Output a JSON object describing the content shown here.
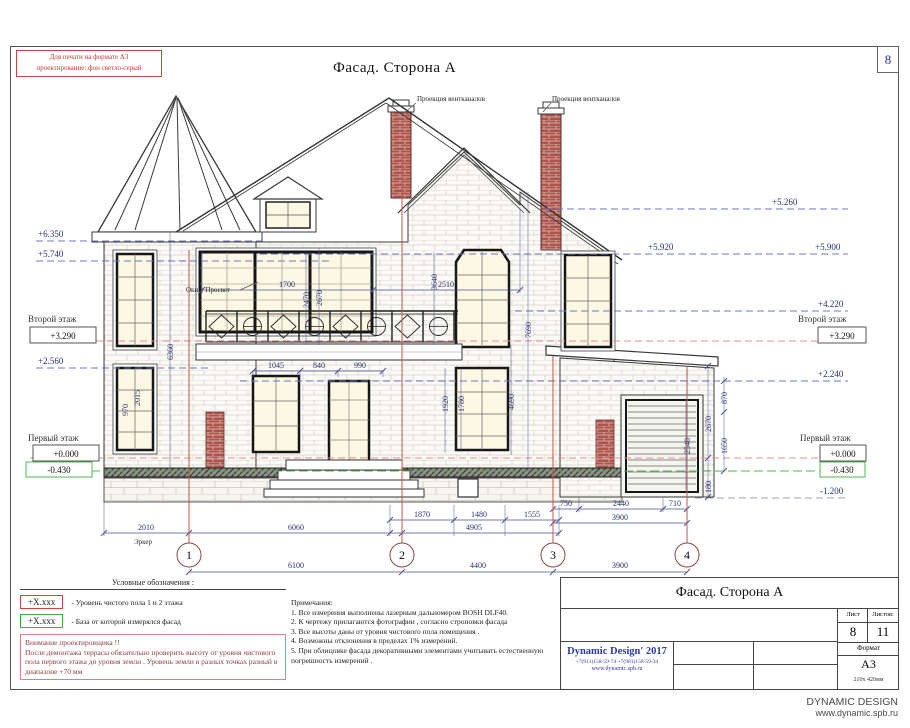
{
  "sheet": {
    "print_note_1": "Для печати на формате А3",
    "print_note_2": "проектирование: фон светло-серый",
    "page_number": "8",
    "title": "Фасад. Сторона А"
  },
  "annotations": {
    "vent_label_1": "Проекция вентканалов",
    "vent_label_2": "Проекция вентканалов",
    "window_label": "Окно: Просвет",
    "bay_label": "Эркер"
  },
  "levels": {
    "l_6350": "+6.350",
    "l_5740": "+5.740",
    "l_2560": "+2.560",
    "l_5260": "+5.260",
    "l_5920": "+5.920",
    "l_5900": "+5.900",
    "l_4220": "+4.220",
    "l_2240": "+2.240",
    "l_1200": "-1.200",
    "floor2_left": "Второй этаж",
    "floor2_right": "Второй этаж",
    "floor2_value_left": "+3.290",
    "floor2_value_right": "+3.290",
    "floor1_left": "Первый этаж",
    "floor1_right": "Первый этаж",
    "floor1_value_left": "+0.000",
    "floor1_value_right": "+0.000",
    "base_value_left": "-0.430",
    "base_value_right": "-0.430"
  },
  "dims": {
    "d2010": "2010",
    "d6060": "6060",
    "d4905": "4905",
    "d1870": "1870",
    "d1480": "1480",
    "d1555": "1555",
    "d750": "750",
    "d2440": "2440",
    "d710": "710",
    "d3900": "3900",
    "d6100": "6100",
    "d4400": "4400",
    "d3900_axis": "3900",
    "d1700": "1700",
    "d2510": "2510",
    "d1045": "1045",
    "d840": "840",
    "d990": "990",
    "v2470": "2470",
    "v2670": "2670",
    "v3640": "3640",
    "v7690": "7690",
    "v4690": "4690",
    "v6360": "6360",
    "v1920": "1920",
    "v1780": "1780",
    "v2540": "2540",
    "v870": "870",
    "v2670b": "2670",
    "v1650": "1650",
    "v180": "180",
    "v970": "970",
    "v2015": "2015"
  },
  "grid": {
    "b1": "1",
    "b2": "2",
    "b3": "3",
    "b4": "4"
  },
  "legend": {
    "title": "Условные обозначения :",
    "item1_key": "+X.xxx",
    "item1_text": "- Уровень чистого пола  1 и 2  этажа",
    "item2_key": "+X.xxx",
    "item2_text": "- База от которой измерялся фасад",
    "warning_title": "Внимание проектировщика !!",
    "warning_text": "После демонтажа  террасы обязательно проверить высоту от уровня чистового пола первого  этажа до уровня земли  . Уровень земли в разных точках  разный в диапазоне  +70 мм"
  },
  "notes": {
    "title": "Примечания:",
    "n1": "1. Все измерения выполнены лазерным дальномером     BOSH DLF40.",
    "n2": "2. К чертежу прилагаются фотографии , согласно строповки фасада",
    "n3": "3. Все высоты даны от уровня чистового пола помещения   .",
    "n4": "4. Возможны отклонения в пределах   1% измерений.",
    "n5": "5. При облицовке фасада декоративными элементами учитывать естественную погрешность измерений  ."
  },
  "titleblock": {
    "title": "Фасад. Сторона А",
    "sheet_label": "Лист",
    "sheets_label": "Листов:",
    "sheet_value": "8",
    "sheets_value": "11",
    "company": "Dynamic Design' 2017",
    "phones": "+7(911)158-59-74    +7(981)158-59-34",
    "site": "www.dynamic.spb.ru",
    "format_label": "Формат",
    "format_value": "А3",
    "format_size": "210х 420мм"
  },
  "footer": {
    "brand": "DYNAMIC DESIGN",
    "site": "www.dynamic.spb.ru"
  },
  "colors": {
    "dim_blue": "#28316e",
    "datum_blue": "#6c79c0",
    "datum_red": "#e09090",
    "datum_green": "#4db84d",
    "brick_red": "#b0544b",
    "leader_red": "#c0564e",
    "company_blue": "#2d3b9e"
  }
}
